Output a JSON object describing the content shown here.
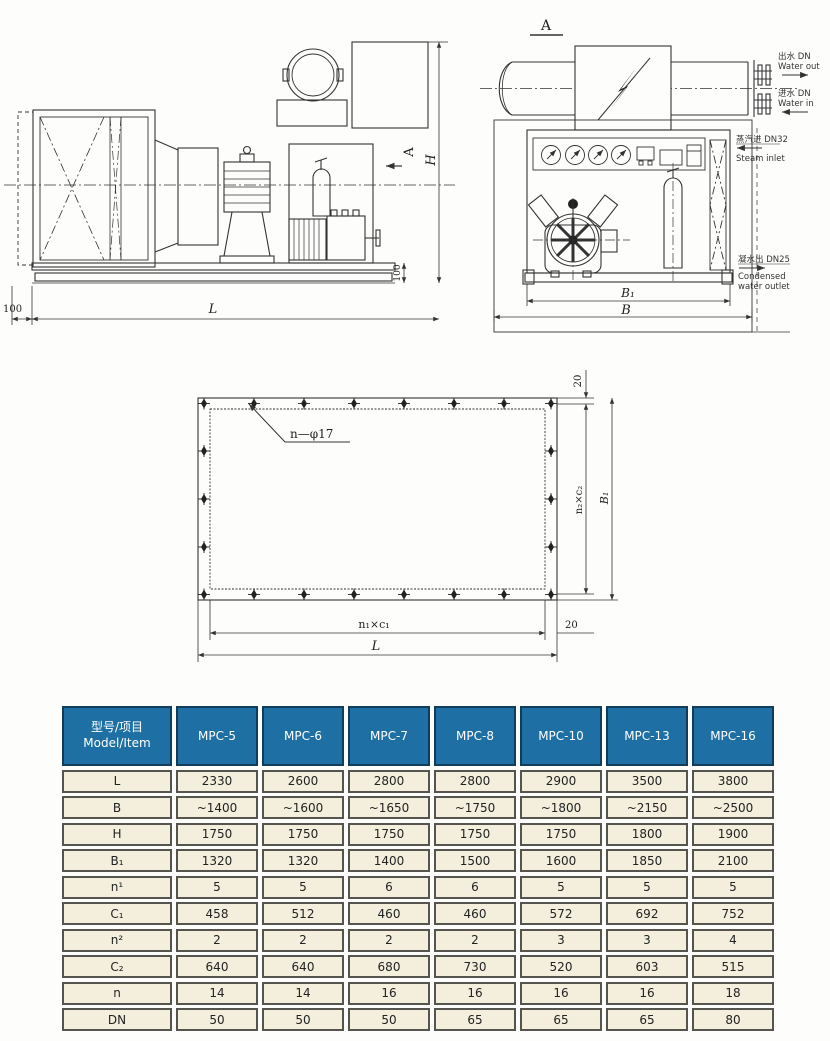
{
  "drawings": {
    "side_view": {
      "view_arrow_label": "A",
      "dim_H": "H",
      "dim_100_right": "100",
      "dim_100_left": "100",
      "dim_L": "L"
    },
    "front_view": {
      "view_label": "A",
      "dim_B1": "B₁",
      "dim_B": "B",
      "water_out_cn": "出水 DN",
      "water_out_en": "Water out",
      "water_in_cn": "进水 DN",
      "water_in_en": "Water in",
      "steam_cn": "蒸汽进 DN32",
      "steam_en": "Steam inlet",
      "cond_cn": "凝水出 DN25",
      "cond_en1": "Condensed",
      "cond_en2": "water outlet"
    },
    "flange_view": {
      "hole_label": "n—φ17",
      "dim_20_top": "20",
      "dim_n2c2": "n₂×c₂",
      "dim_B1": "B₁",
      "dim_20_bottom": "20",
      "dim_n1c1": "n₁×c₁",
      "dim_L": "L"
    }
  },
  "table": {
    "colors": {
      "header_bg": "#1e6fa3",
      "cell_bg": "#f4efdc"
    },
    "header": {
      "model_item_cn": "型号/项目",
      "model_item_en": "Model/Item",
      "models": [
        "MPC-5",
        "MPC-6",
        "MPC-7",
        "MPC-8",
        "MPC-10",
        "MPC-13",
        "MPC-16"
      ]
    },
    "rows": [
      {
        "label": "L",
        "values": [
          "2330",
          "2600",
          "2800",
          "2800",
          "2900",
          "3500",
          "3800"
        ]
      },
      {
        "label": "B",
        "values": [
          "~1400",
          "~1600",
          "~1650",
          "~1750",
          "~1800",
          "~2150",
          "~2500"
        ]
      },
      {
        "label": "H",
        "values": [
          "1750",
          "1750",
          "1750",
          "1750",
          "1750",
          "1800",
          "1900"
        ]
      },
      {
        "label": "B₁",
        "values": [
          "1320",
          "1320",
          "1400",
          "1500",
          "1600",
          "1850",
          "2100"
        ]
      },
      {
        "label": "n¹",
        "values": [
          "5",
          "5",
          "6",
          "6",
          "5",
          "5",
          "5"
        ]
      },
      {
        "label": "C₁",
        "values": [
          "458",
          "512",
          "460",
          "460",
          "572",
          "692",
          "752"
        ]
      },
      {
        "label": "n²",
        "values": [
          "2",
          "2",
          "2",
          "2",
          "3",
          "3",
          "4"
        ]
      },
      {
        "label": "C₂",
        "values": [
          "640",
          "640",
          "680",
          "730",
          "520",
          "603",
          "515"
        ]
      },
      {
        "label": "n",
        "values": [
          "14",
          "14",
          "16",
          "16",
          "16",
          "16",
          "18"
        ]
      },
      {
        "label": "DN",
        "values": [
          "50",
          "50",
          "50",
          "65",
          "65",
          "65",
          "80"
        ]
      }
    ]
  }
}
